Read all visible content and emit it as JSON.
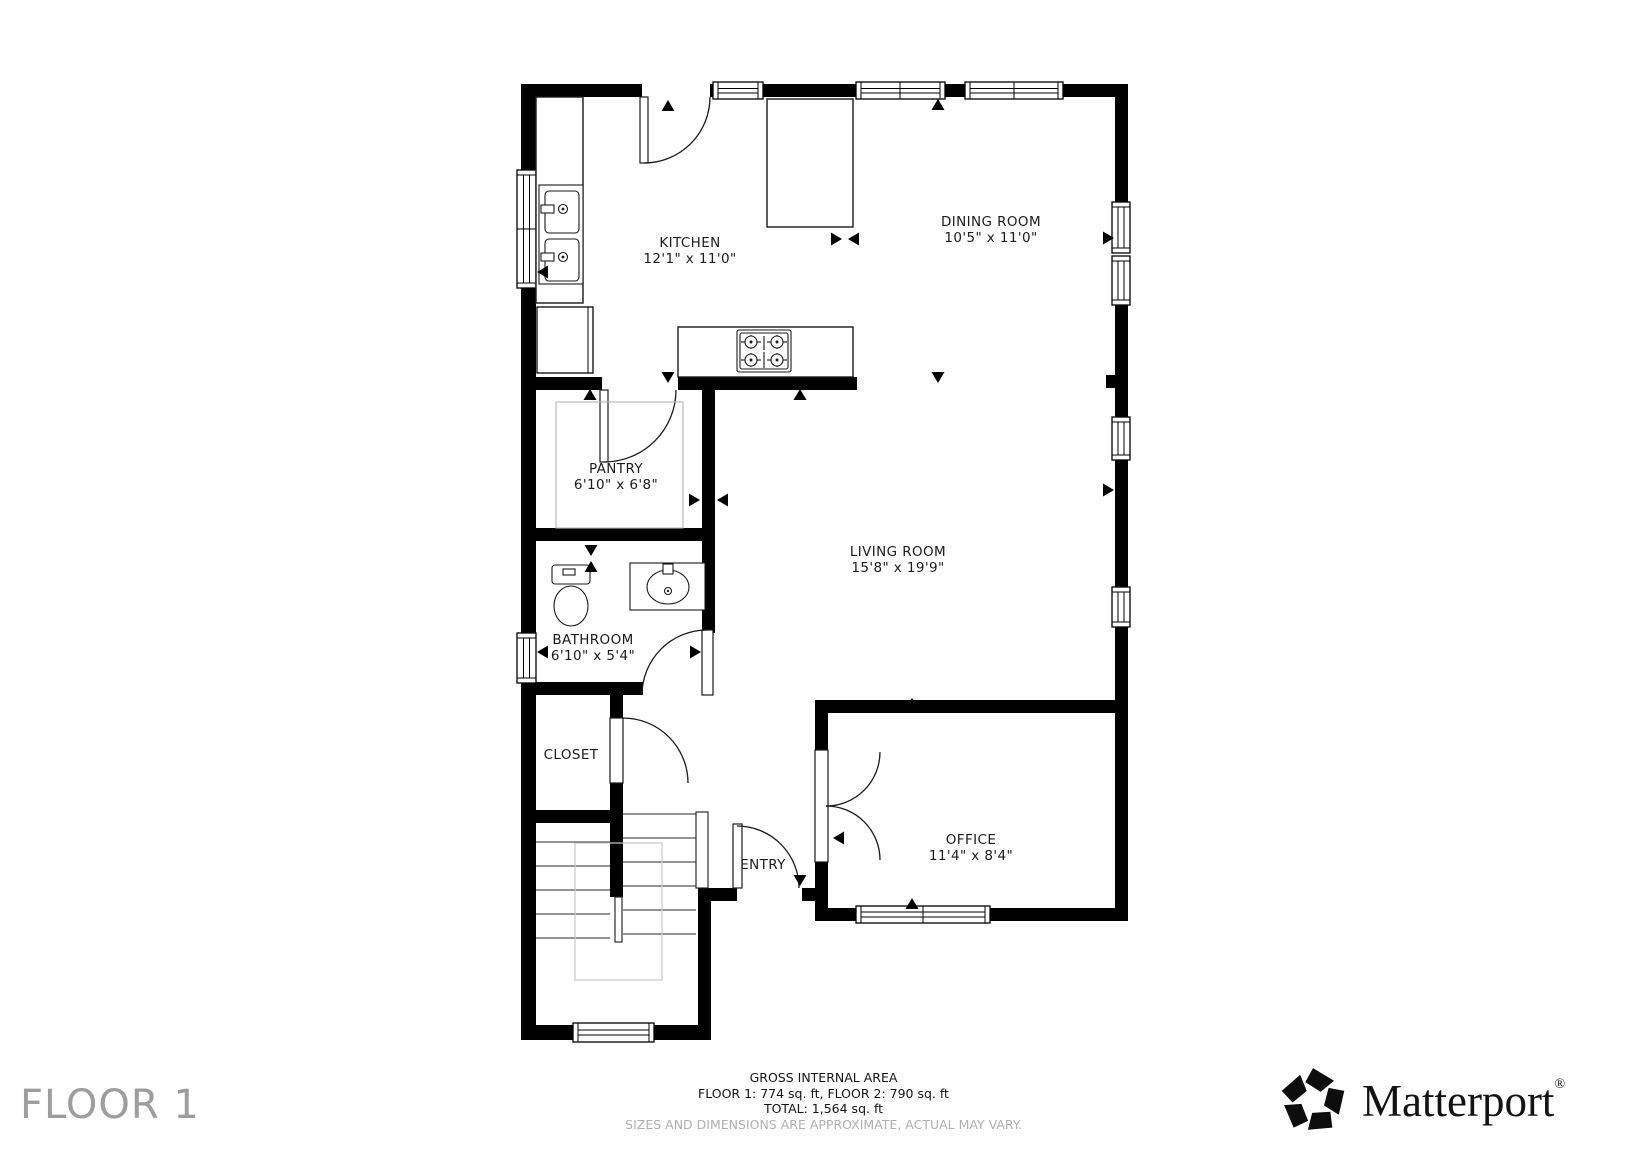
{
  "floor": {
    "label": "FLOOR 1"
  },
  "rooms": [
    {
      "id": "kitchen",
      "name": "KITCHEN",
      "dimensions": "12'1\" x 11'0\""
    },
    {
      "id": "dining-room",
      "name": "DINING ROOM",
      "dimensions": "10'5\" x 11'0\""
    },
    {
      "id": "pantry",
      "name": "PANTRY",
      "dimensions": "6'10\" x 6'8\""
    },
    {
      "id": "living-room",
      "name": "LIVING ROOM",
      "dimensions": "15'8\" x 19'9\""
    },
    {
      "id": "bathroom",
      "name": "BATHROOM",
      "dimensions": "6'10\" x 5'4\""
    },
    {
      "id": "closet",
      "name": "CLOSET",
      "dimensions": ""
    },
    {
      "id": "entry",
      "name": "ENTRY",
      "dimensions": ""
    },
    {
      "id": "office",
      "name": "OFFICE",
      "dimensions": "11'4\" x 8'4\""
    }
  ],
  "footer": {
    "title": "GROSS INTERNAL AREA",
    "areas_line": "FLOOR 1: 774 sq. ft, FLOOR 2: 790 sq. ft",
    "total_line": "TOTAL: 1,564 sq. ft",
    "disclaimer": "SIZES AND DIMENSIONS ARE APPROXIMATE, ACTUAL MAY VARY."
  },
  "brand": {
    "wordmark": "Matterport",
    "registered_mark": "®"
  },
  "colors": {
    "wall": "#000000",
    "background": "#ffffff",
    "room_label_text": "#1b1b1b",
    "muted_text": "#9d9d9d",
    "disclaimer_text": "#b0b0b0"
  }
}
